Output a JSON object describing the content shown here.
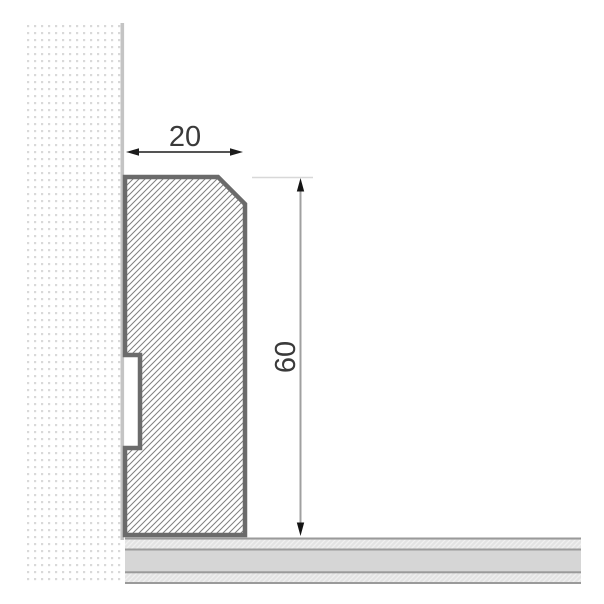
{
  "diagram": {
    "type": "technical-cross-section-drawing",
    "subject": "skirting-board-profile-on-wall-and-floor",
    "dimensions": {
      "width": {
        "label": "20",
        "unit_hint": "mm-style dimension across top of profile"
      },
      "height": {
        "label": "60",
        "unit_hint": "mm-style dimension along right side of profile"
      }
    },
    "parts": {
      "wall": "dotted hatch wall section (left)",
      "skirting_board": "diagonal hatch skirting board profile with top chamfer and rear groove",
      "floor": "layered floor section (bottom)"
    },
    "colors": {
      "background": "#ffffff",
      "profile_outline": "#6b6b6b",
      "profile_hatch_line": "#7f7f7f",
      "wall_dot": "#d9d9d9",
      "wall_edge_line": "#c4c4c4",
      "floor_solid_band": "#d6d6d6",
      "floor_border_line": "#9a9a9a",
      "floor_hatch_bg": "#e3e3e3",
      "dimension_line_black": "#1c1c1c",
      "dimension_line_gray": "#a0a0a0",
      "dimension_extension_line": "#d8d8d8",
      "dimension_text": "#3a3a3a"
    }
  }
}
